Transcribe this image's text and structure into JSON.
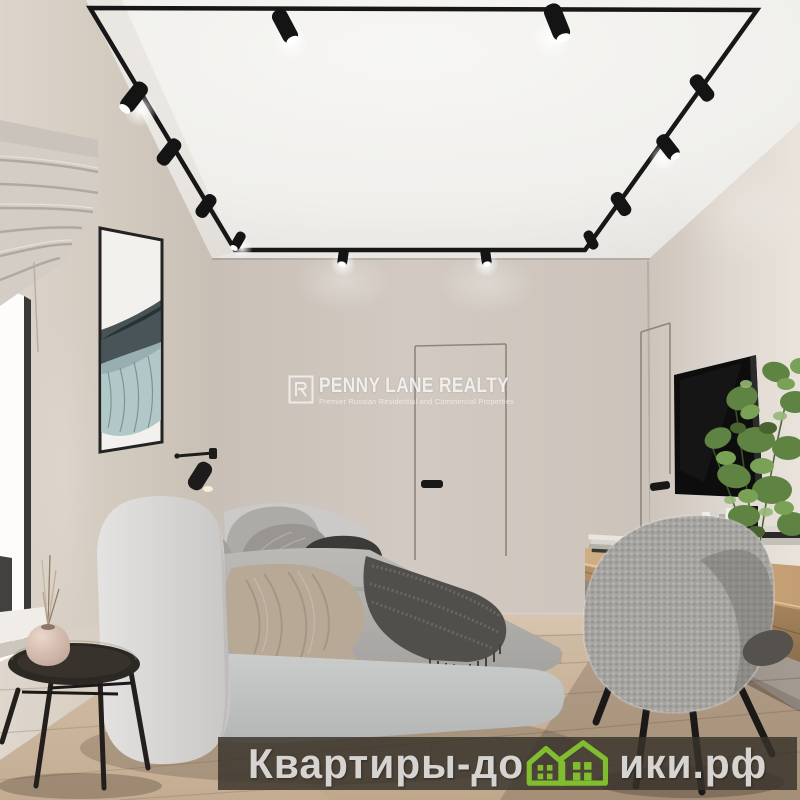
{
  "image": {
    "kind": "real-estate interior render photo",
    "room": "minimalist bedroom with track lighting"
  },
  "watermark_center": {
    "brand": "PENNY LANE REALTY",
    "tagline": "Premier Russian Residential and Commercial Properties",
    "logo_icon": "penny-lane-square-monogram",
    "text_color": "#ffffff"
  },
  "watermark_bottom": {
    "full_text": "Квартиры-домики.рф",
    "text_before_icon": "Квартиры-до",
    "text_after_icon": "ики.рф",
    "icon": "two-green-houses-replacing-letter-m",
    "text_color": "#d6d4d1",
    "house_green": "#80bd2f",
    "band_color": "rgba(56,50,43,0.82)"
  },
  "scene": {
    "objects": [
      "white ceiling with black rectangular track and 12 spotlights",
      "left wall with window, grey roman shade, abstract framed artwork",
      "black wall reading lamp",
      "grey upholstered bed with pillows, taupe blanket, dark fringed throw",
      "black round side table with blush vase and dried stems",
      "back wall flush door with black handle",
      "right wall flush door with black handle",
      "wall-mounted black TV",
      "floating wood desk with books and black sculpture",
      "green potted plant",
      "grey boucle chair with black legs",
      "light oak plank floor"
    ],
    "palette": {
      "ceiling": "#f2f1ee",
      "left_wall": "#d3cabf",
      "back_wall": "#cdc5bd",
      "right_wall": "#ddd6ce",
      "floor_wood": "#c7b098",
      "track_black": "#171717",
      "bed_grey": "#c6c8c7",
      "desk_wood": "#c2a076",
      "plant_green": "#5f8342"
    }
  }
}
